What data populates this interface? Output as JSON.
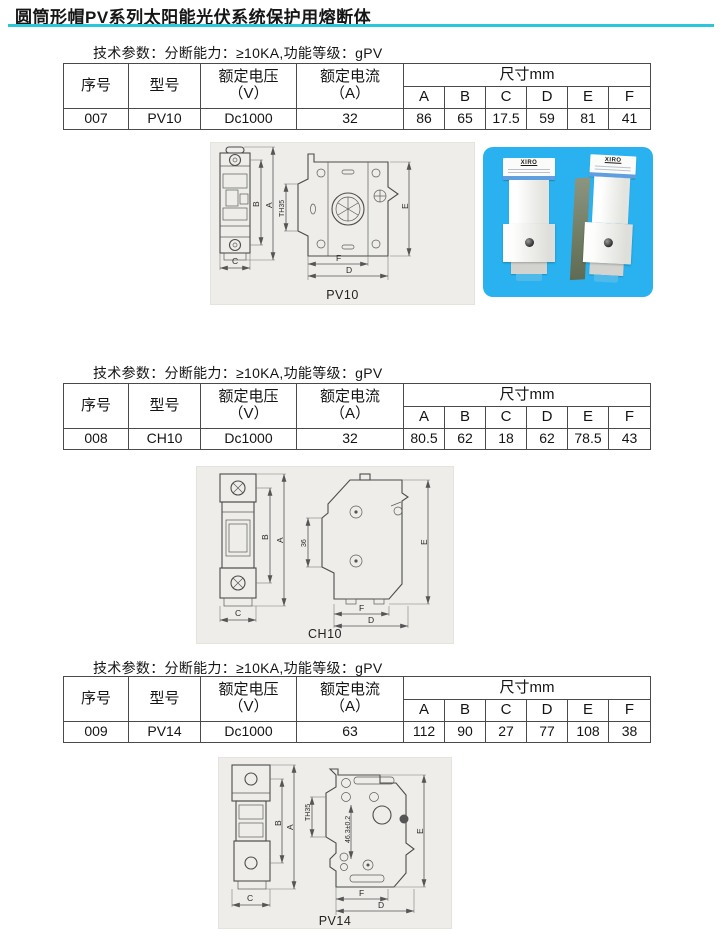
{
  "title": "圆筒形帽PV系列太阳能光伏系统保护用熔断体",
  "colors": {
    "accent_underline": "#2bc7d9",
    "photo_background": "#29b2ef",
    "drawing_background": "#eeede9",
    "label_stripe_blue": "#5f9fe0"
  },
  "table": {
    "serial": "序号",
    "model": "型号",
    "voltage1": "额定电压",
    "voltage2": "（V）",
    "current1": "额定电流",
    "current2": "（A）",
    "dims": "尺寸mm",
    "dim_cols": [
      "A",
      "B",
      "C",
      "D",
      "E",
      "F"
    ]
  },
  "sections": [
    {
      "tech": "技术参数：分断能力：≥10KA,功能等级：gPV",
      "row": {
        "serial": "007",
        "model": "PV10",
        "voltage": "Dc1000",
        "current": "32",
        "A": "86",
        "B": "65",
        "C": "17.5",
        "D": "59",
        "E": "81",
        "F": "41"
      },
      "drawing": {
        "caption": "PV10",
        "a": "A",
        "b": "B",
        "c": "C",
        "d": "D",
        "e": "E",
        "f": "F",
        "rail": "TH35"
      }
    },
    {
      "tech": "技术参数：分断能力：≥10KA,功能等级：gPV",
      "row": {
        "serial": "008",
        "model": "CH10",
        "voltage": "Dc1000",
        "current": "32",
        "A": "80.5",
        "B": "62",
        "C": "18",
        "D": "62",
        "E": "78.5",
        "F": "43"
      },
      "drawing": {
        "caption": "CH10",
        "a": "A",
        "b": "B",
        "c": "C",
        "d": "D",
        "e": "E",
        "f": "F",
        "rail": "36"
      }
    },
    {
      "tech": "技术参数：分断能力：≥10KA,功能等级：gPV",
      "row": {
        "serial": "009",
        "model": "PV14",
        "voltage": "Dc1000",
        "current": "63",
        "A": "112",
        "B": "90",
        "C": "27",
        "D": "77",
        "E": "108",
        "F": "38"
      },
      "drawing": {
        "caption": "PV14",
        "a": "A",
        "b": "B",
        "c": "C",
        "d": "D",
        "e": "E",
        "f": "F",
        "rail": "TH35",
        "extra": "46.3±0.2"
      }
    }
  ],
  "photo": {
    "brand": "XIRO"
  }
}
